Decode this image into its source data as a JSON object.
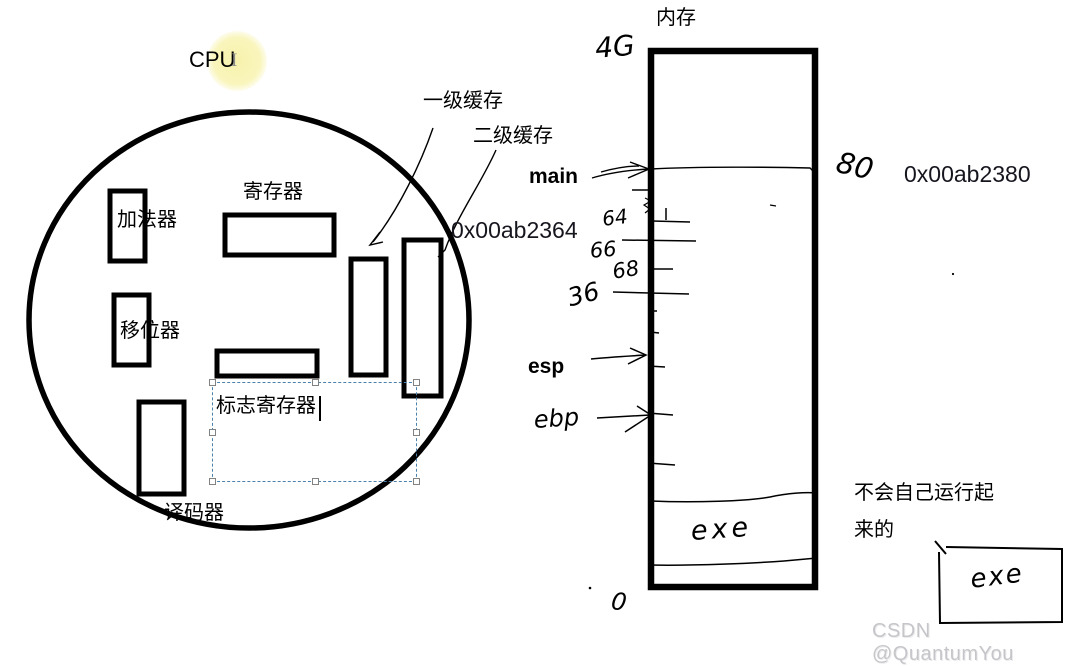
{
  "app": {
    "watermark": "CSDN @QuantumYou"
  },
  "cpu": {
    "title": "CPU",
    "components": {
      "adder": "加法器",
      "register": "寄存器",
      "shifter": "移位器",
      "flag_register": "标志寄存器",
      "decoder": "译码器"
    },
    "caches": {
      "l1_label": "一级缓存",
      "l2_label": "二级缓存",
      "address": "0x00ab2364"
    }
  },
  "memory": {
    "title": "内存",
    "capacity_mark": "4G",
    "zero_mark": "0",
    "main_pointer": "main",
    "main_offset": "80",
    "main_address": "0x00ab2380",
    "esp_pointer": "esp",
    "ebp_pointer": "ebp",
    "offset_marks": [
      "64",
      "66",
      "68",
      "36"
    ],
    "exe_mark": "exe"
  },
  "note": {
    "line1": "不会自己运行起",
    "line2": "来的"
  },
  "exe_box": {
    "label": "exe"
  },
  "icons": {
    "text_cursor": "I"
  },
  "colors": {
    "ink": "#000000",
    "address_text": "#16161f",
    "selection_dash": "#4a82ad",
    "highlight": "#f8f3b4",
    "watermark": "#c6c6ca"
  }
}
